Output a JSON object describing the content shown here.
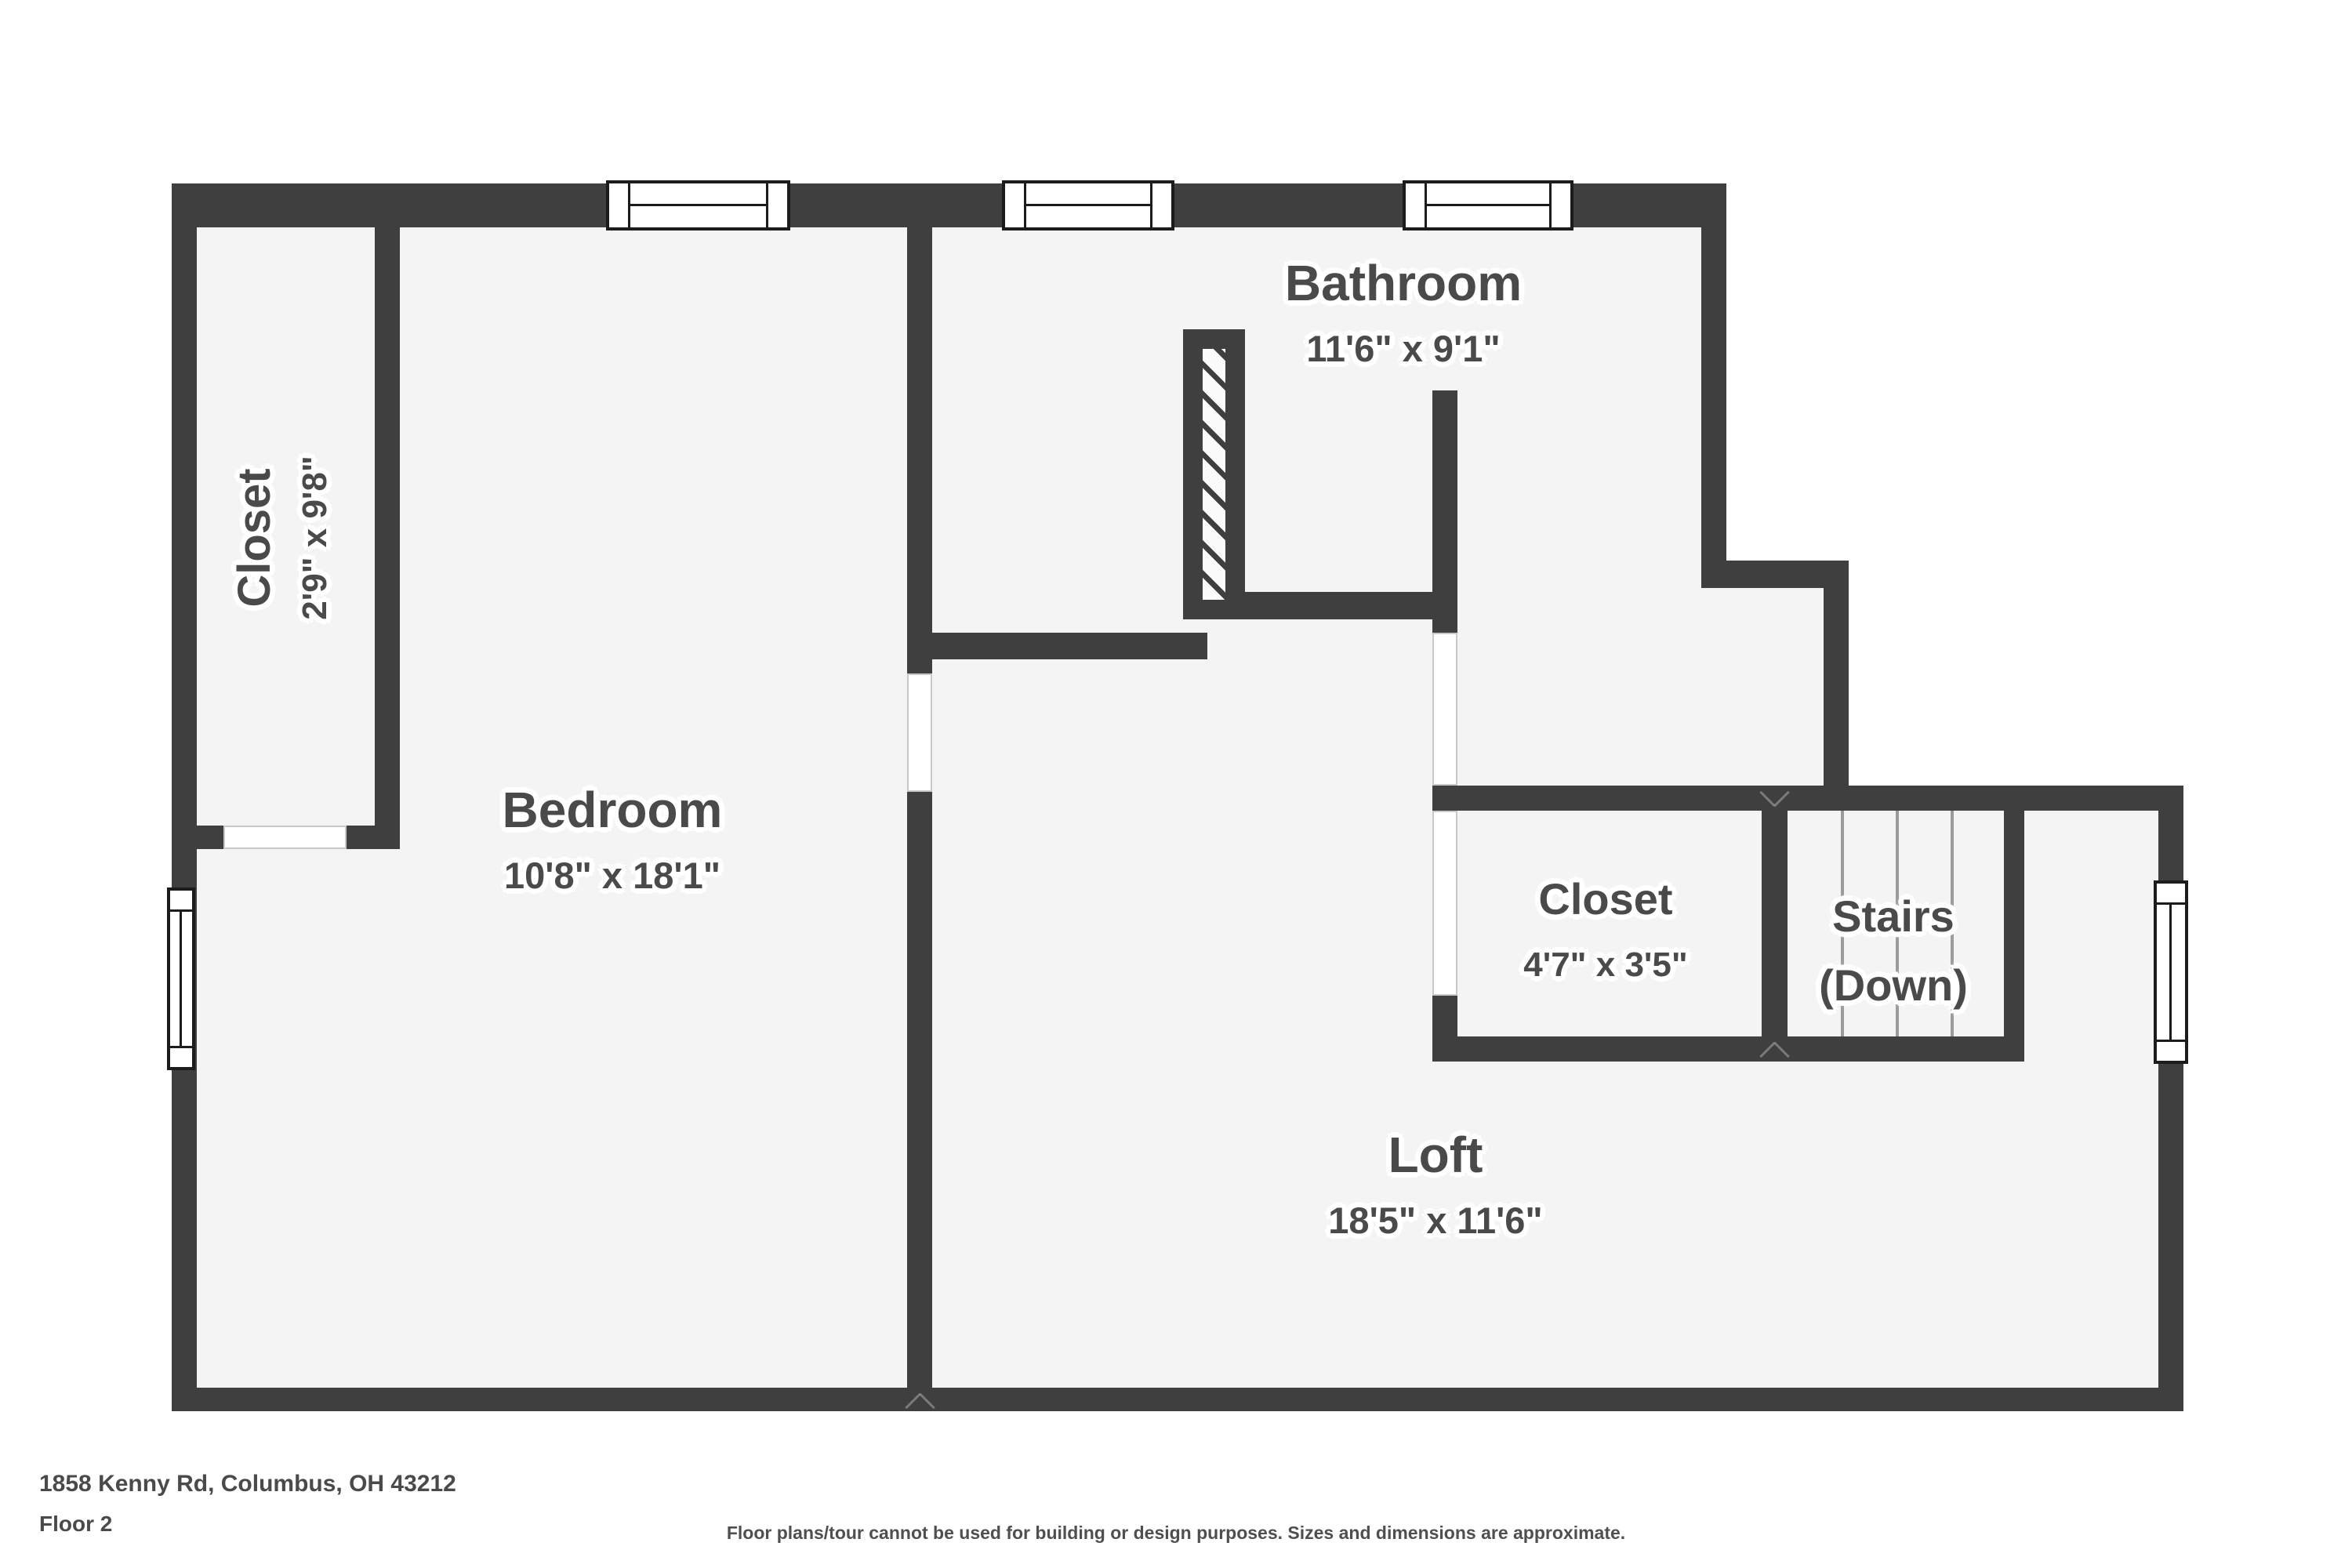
{
  "page": {
    "address": "1858 Kenny Rd, Columbus, OH 43212",
    "floor_label": "Floor 2",
    "disclaimer": "Floor plans/tour cannot be used for building or design purposes. Sizes and dimensions are approximate."
  },
  "colors": {
    "wall": "#3f3f3f",
    "room_fill": "#f4f4f4",
    "outside": "#ffffff",
    "label_text": "#4a4a4a",
    "stair_tread": "#9b9b9b",
    "window_border": "#1c1c1c",
    "opening_border": "#c9c9c9"
  },
  "rooms": [
    {
      "id": "bathroom",
      "name": "Bathroom",
      "subtitle": "11'6\" x 9'1\""
    },
    {
      "id": "closet-left",
      "name": "Closet",
      "subtitle": "2'9\" x 9'8\""
    },
    {
      "id": "bedroom",
      "name": "Bedroom",
      "subtitle": "10'8\" x 18'1\""
    },
    {
      "id": "closet-right",
      "name": "Closet",
      "subtitle": "4'7\" x 3'5\""
    },
    {
      "id": "stairs",
      "name": "Stairs",
      "subtitle": "(Down)"
    },
    {
      "id": "loft",
      "name": "Loft",
      "subtitle": "18'5\" x 11'6\""
    }
  ]
}
